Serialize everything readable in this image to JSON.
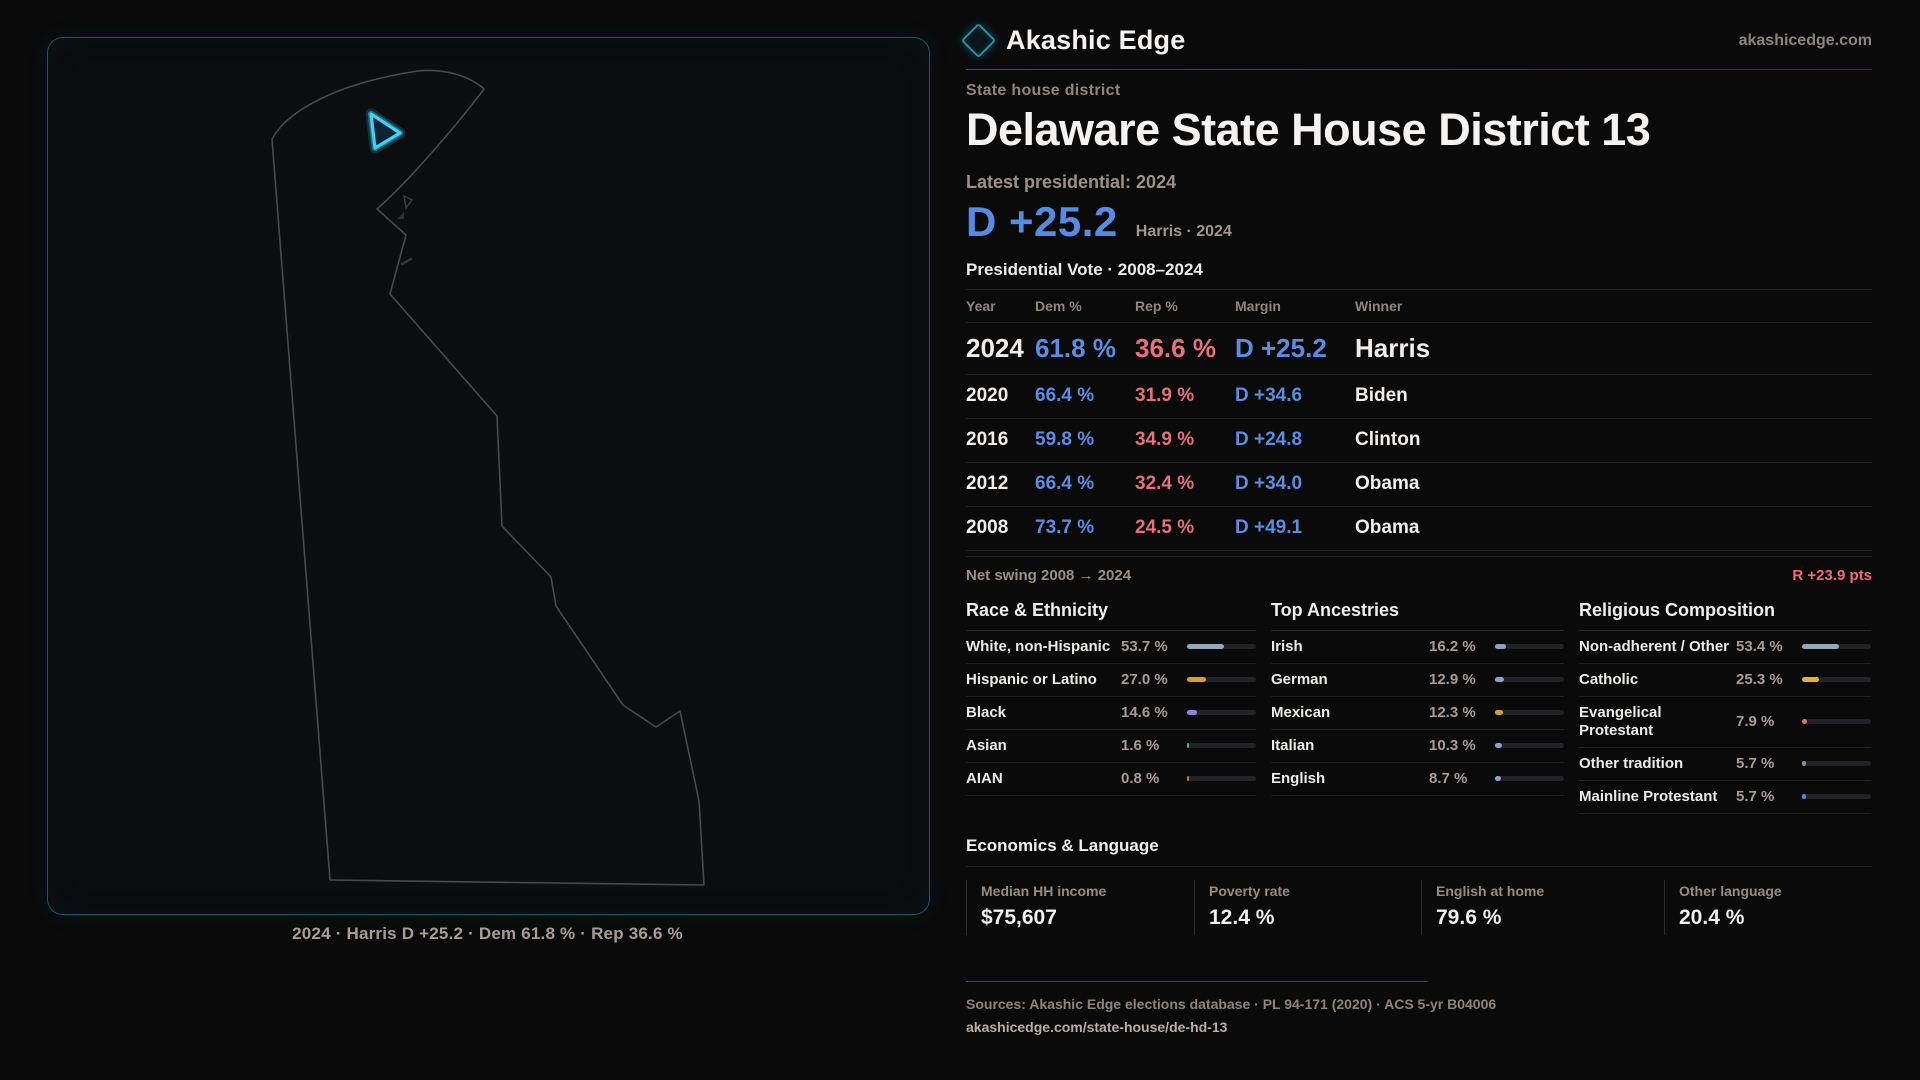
{
  "brand": {
    "name": "Akashic Edge",
    "domain": "akashicedge.com"
  },
  "page": {
    "kicker": "State house district",
    "title": "Delaware State House District 13",
    "latest_label": "Latest presidential: 2024",
    "margin_big": "D +25.2",
    "margin_context": "Harris · 2024",
    "table_title": "Presidential Vote · 2008–2024"
  },
  "map": {
    "caption": "2024 · Harris D +25.2 · Dem 61.8 % · Rep 36.6 %"
  },
  "vote_table": {
    "columns": [
      "Year",
      "Dem %",
      "Rep %",
      "Margin",
      "Winner"
    ],
    "rows": [
      {
        "year": "2024",
        "dem": "61.8 %",
        "rep": "36.6 %",
        "margin": "D +25.2",
        "winner": "Harris",
        "highlight": true
      },
      {
        "year": "2020",
        "dem": "66.4 %",
        "rep": "31.9 %",
        "margin": "D +34.6",
        "winner": "Biden",
        "highlight": false
      },
      {
        "year": "2016",
        "dem": "59.8 %",
        "rep": "34.9 %",
        "margin": "D +24.8",
        "winner": "Clinton",
        "highlight": false
      },
      {
        "year": "2012",
        "dem": "66.4 %",
        "rep": "32.4 %",
        "margin": "D +34.0",
        "winner": "Obama",
        "highlight": false
      },
      {
        "year": "2008",
        "dem": "73.7 %",
        "rep": "24.5 %",
        "margin": "D +49.1",
        "winner": "Obama",
        "highlight": false
      }
    ]
  },
  "net_swing": {
    "label": "Net swing 2008 → 2024",
    "value": "R +23.9 pts"
  },
  "demographics": {
    "columns": [
      {
        "title": "Race & Ethnicity",
        "rows": [
          {
            "label": "White, non-Hispanic",
            "value": "53.7 %",
            "pct": 53.7,
            "color": "#93a7bc"
          },
          {
            "label": "Hispanic or Latino",
            "value": "27.0 %",
            "pct": 27.0,
            "color": "#dd9b28"
          },
          {
            "label": "Black",
            "value": "14.6 %",
            "pct": 14.6,
            "color": "#9180e0"
          },
          {
            "label": "Asian",
            "value": "1.6 %",
            "pct": 1.6,
            "color": "#2ec27e"
          },
          {
            "label": "AIAN",
            "value": "0.8 %",
            "pct": 0.8,
            "color": "#c7752b"
          }
        ]
      },
      {
        "title": "Top Ancestries",
        "rows": [
          {
            "label": "Irish",
            "value": "16.2 %",
            "pct": 16.2,
            "color": "#88a4c4"
          },
          {
            "label": "German",
            "value": "12.9 %",
            "pct": 12.9,
            "color": "#88a4c4"
          },
          {
            "label": "Mexican",
            "value": "12.3 %",
            "pct": 12.3,
            "color": "#dd9b28"
          },
          {
            "label": "Italian",
            "value": "10.3 %",
            "pct": 10.3,
            "color": "#88a4c4"
          },
          {
            "label": "English",
            "value": "8.7 %",
            "pct": 8.7,
            "color": "#88a4c4"
          }
        ]
      },
      {
        "title": "Religious Composition",
        "rows": [
          {
            "label": "Non-adherent / Other",
            "value": "53.4 %",
            "pct": 53.4,
            "color": "#93a7bc"
          },
          {
            "label": "Catholic",
            "value": "25.3 %",
            "pct": 25.3,
            "color": "#e2b32c"
          },
          {
            "label": "Evangelical Protestant",
            "value": "7.9 %",
            "pct": 7.9,
            "color": "#e0707a"
          },
          {
            "label": "Other tradition",
            "value": "5.7 %",
            "pct": 5.7,
            "color": "#7e8fa0"
          },
          {
            "label": "Mainline Protestant",
            "value": "5.7 %",
            "pct": 5.7,
            "color": "#4a90d9"
          }
        ]
      }
    ]
  },
  "economics": {
    "title": "Economics & Language",
    "stats": [
      {
        "label": "Median HH income",
        "value": "$75,607"
      },
      {
        "label": "Poverty rate",
        "value": "12.4 %"
      },
      {
        "label": "English at home",
        "value": "79.6 %"
      },
      {
        "label": "Other language",
        "value": "20.4 %"
      }
    ]
  },
  "footer": {
    "sources": "Sources: Akashic Edge elections database · PL 94-171 (2020) · ACS 5-yr B04006",
    "permalink": "akashicedge.com/state-house/de-hd-13"
  },
  "colors": {
    "dem_blue": "#5b8de2",
    "rep_red": "#e4717b",
    "swing_red": "#ee6d75",
    "accent_cyan": "#38cbf2",
    "panel_border_teal": "#1a5668"
  }
}
